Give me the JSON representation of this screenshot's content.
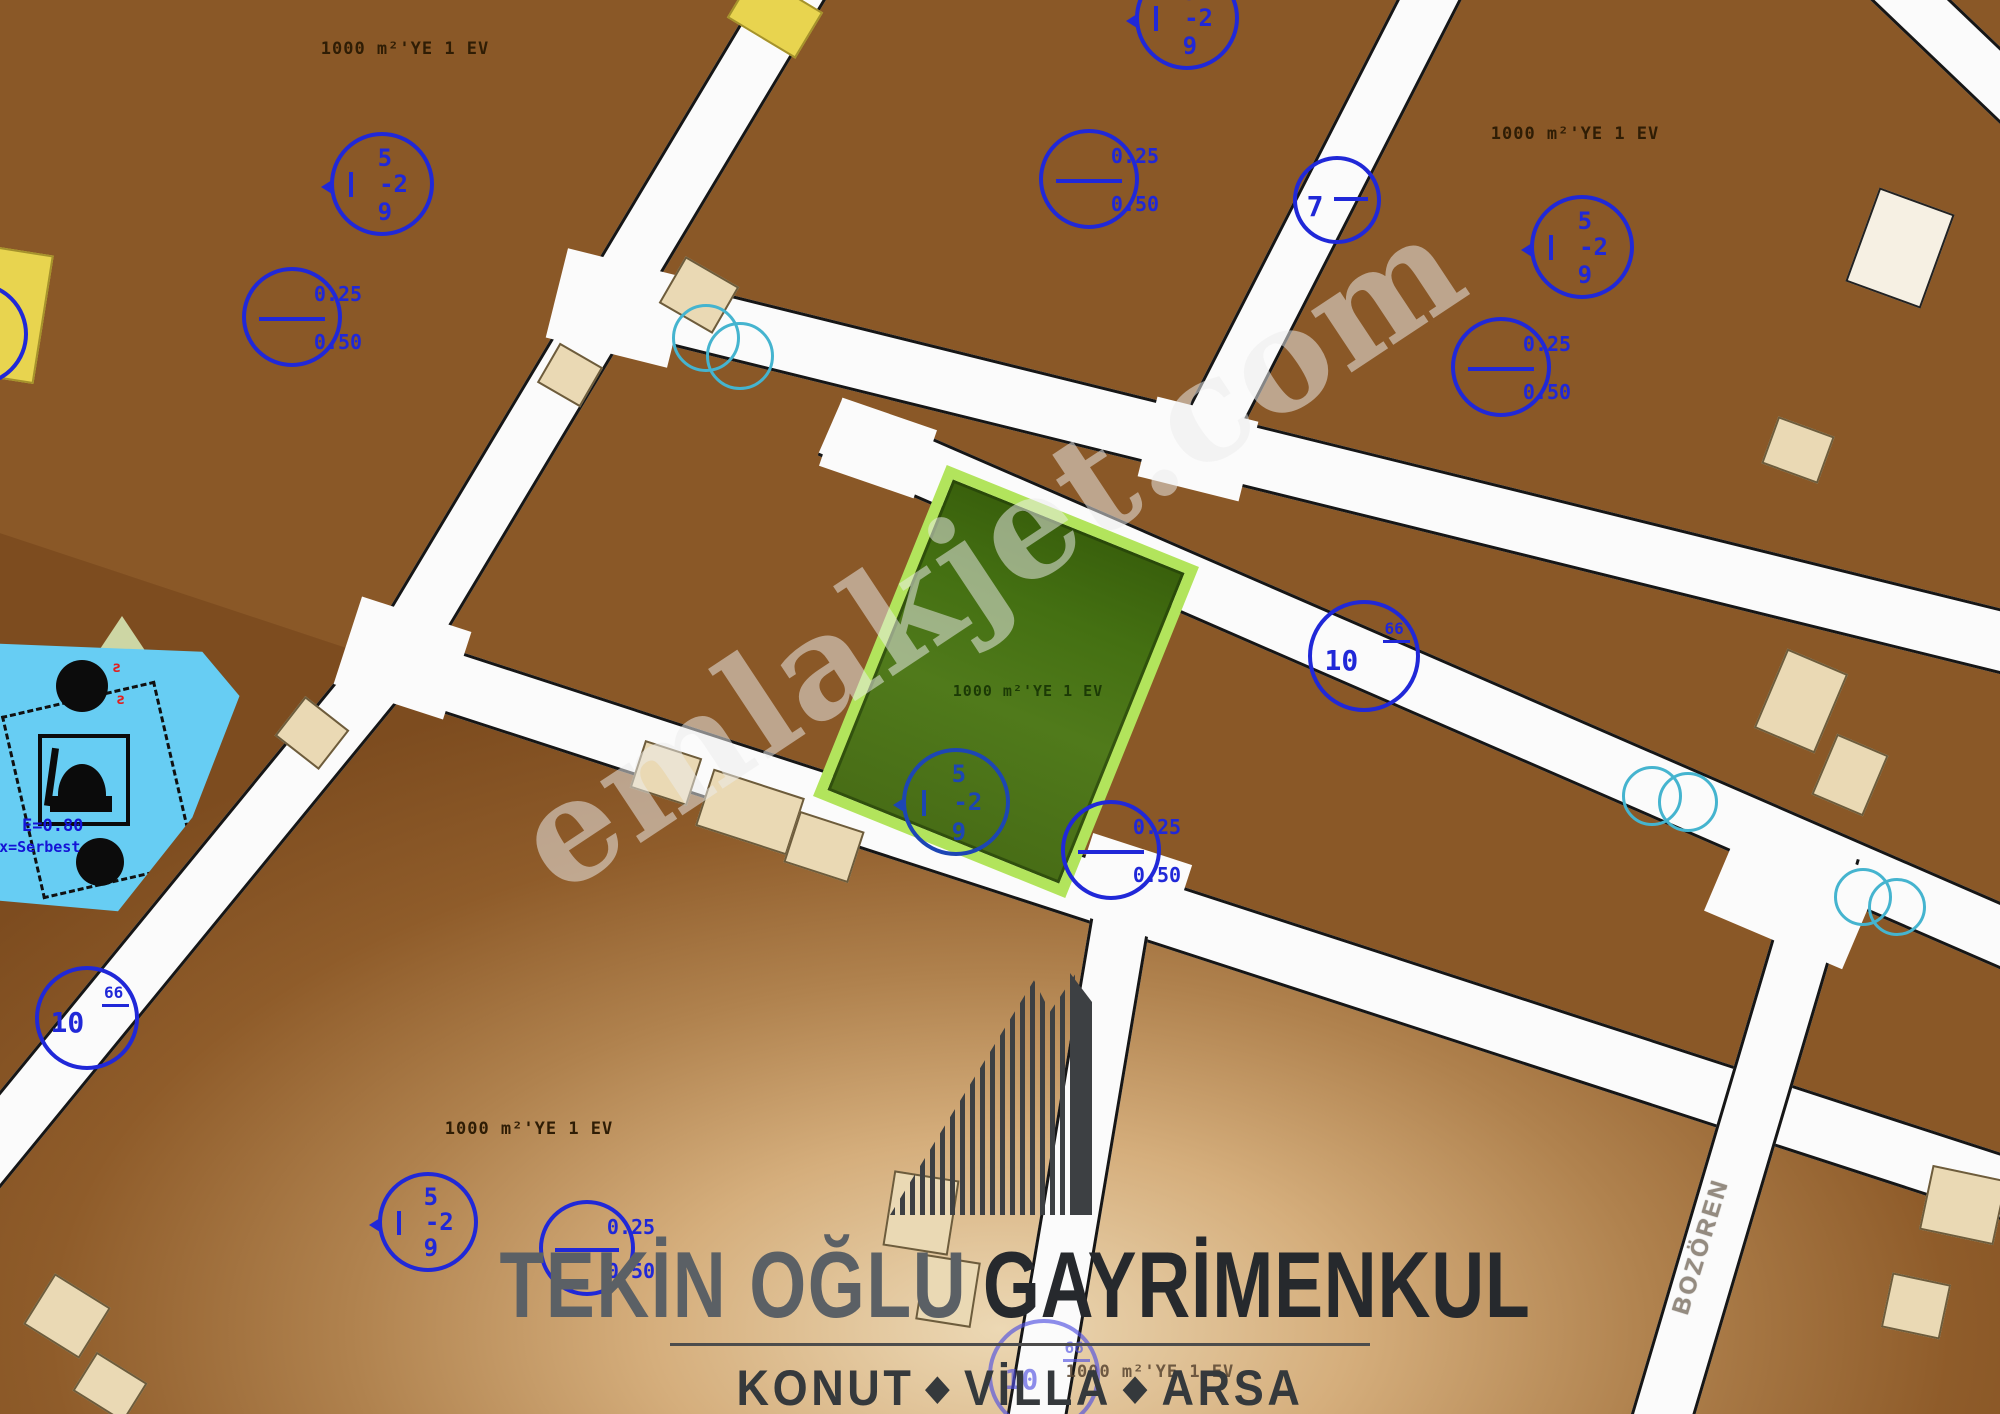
{
  "watermark": "emlakjet.com",
  "logo": {
    "brand_light": "TEKİN OĞLU",
    "brand_dark": "GAYRİMENKUL",
    "tagline": {
      "item1": "KONUT",
      "item2": "VİLLA",
      "item3": "ARSA",
      "separator": "◆"
    }
  },
  "map": {
    "parcel_label": "1000 m²'YE 1 EV",
    "zone_circle": {
      "top": "5",
      "mid": "-2",
      "bottom": "9"
    },
    "ratio_circle": {
      "top": "0.25",
      "bottom": "0.50"
    },
    "road_markers": {
      "seven": "7",
      "ten": "10",
      "ten_sup": "66"
    },
    "worship_area": {
      "line1": "E=0.80",
      "line2": "Hmax=Serbest"
    },
    "street_name": "BOZÖREN",
    "colors": {
      "annotation_blue": "#2028d8",
      "utility_cyan": "#45b4cf",
      "parcel_brown": "#8a5827",
      "highlight_border": "#b2e45c",
      "highlight_fill": "#4a7017",
      "worship_fill": "#67cdf3",
      "road_white": "#fbfbfb"
    }
  }
}
